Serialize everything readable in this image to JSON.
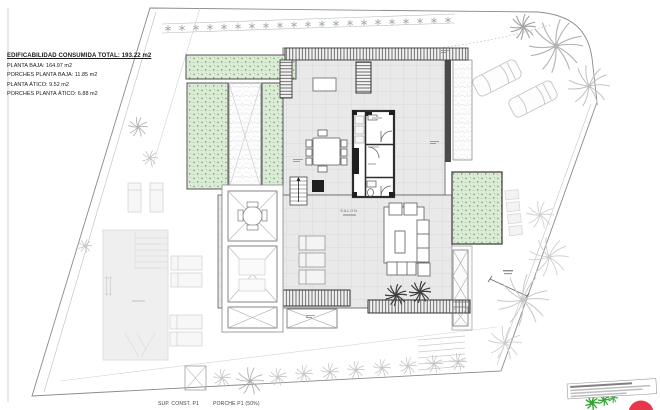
{
  "summary_block": {
    "title": "EDIFICABILIDAD CONSUMIDA TOTAL: 193.22 m2",
    "lines": [
      "PLANTA BAJA: 164.97 m2",
      "PORCHES PLANTA BAJA: 11.85 m2",
      "PLANTA ÁTICO: 9.52 m2",
      "PORCHES PLANTA ÁTICO: 6.88 m2"
    ]
  },
  "plan": {
    "salon_label": "SALON"
  },
  "footer": {
    "sup_const": "SUP. CONST. P1",
    "porche": "PORCHE P1 (50%)"
  },
  "colors": {
    "lawn_fill": "#dcebd5",
    "lawn_dot": "#57a05a",
    "tile_fill": "#e9e9e9",
    "tile_line": "#d4d4d4",
    "wall_dark": "#333333",
    "boundary_line": "#8a8a8a",
    "faint_site": "#c9c9c9",
    "marker_red": "#e8374a",
    "marker_green": "#2fa32f"
  }
}
